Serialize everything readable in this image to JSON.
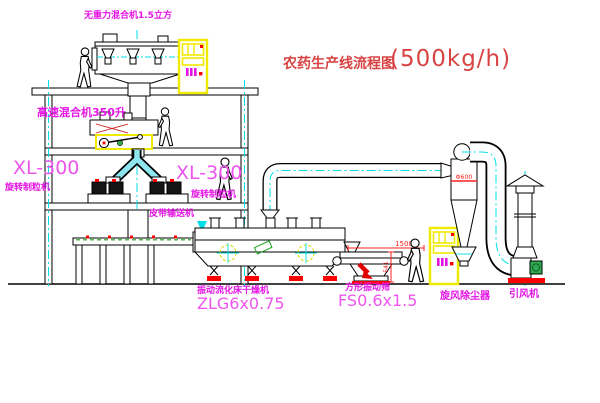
{
  "title": {
    "name_cn": "农药生产线流程图",
    "capacity": "(500kg/h)"
  },
  "equipment": {
    "gravity_mixer": {
      "label": "无重力混合机1.5立方"
    },
    "high_speed_mixer": {
      "label": "高速混合机350升"
    },
    "granulator_left": {
      "model": "XL-300",
      "name": "旋转制粒机"
    },
    "granulator_right": {
      "model": "XL-300",
      "name": "旋转制粒机"
    },
    "belt_conveyor": {
      "name": "皮带输送机"
    },
    "fluid_bed_dryer": {
      "name": "振动流化床干燥机",
      "model": "ZLG6x0.75"
    },
    "vibrating_screen": {
      "name": "方形振动筛",
      "model": "FS0.6x1.5",
      "length_dim": "1500",
      "height_dim": "541"
    },
    "cyclone": {
      "name": "旋风除尘器",
      "diameter_dim": "Φ600"
    },
    "induced_draft_fan": {
      "name": "引风机"
    }
  },
  "colors": {
    "label_magenta": "#e415e4",
    "model_magenta": "#ee55ee",
    "title_red": "#d84343",
    "dimension_red": "#ff2020",
    "centerline_cyan": "#00dfe8",
    "cabinet_yellow": "#f0ea00",
    "motor_green": "#2faa4f"
  }
}
